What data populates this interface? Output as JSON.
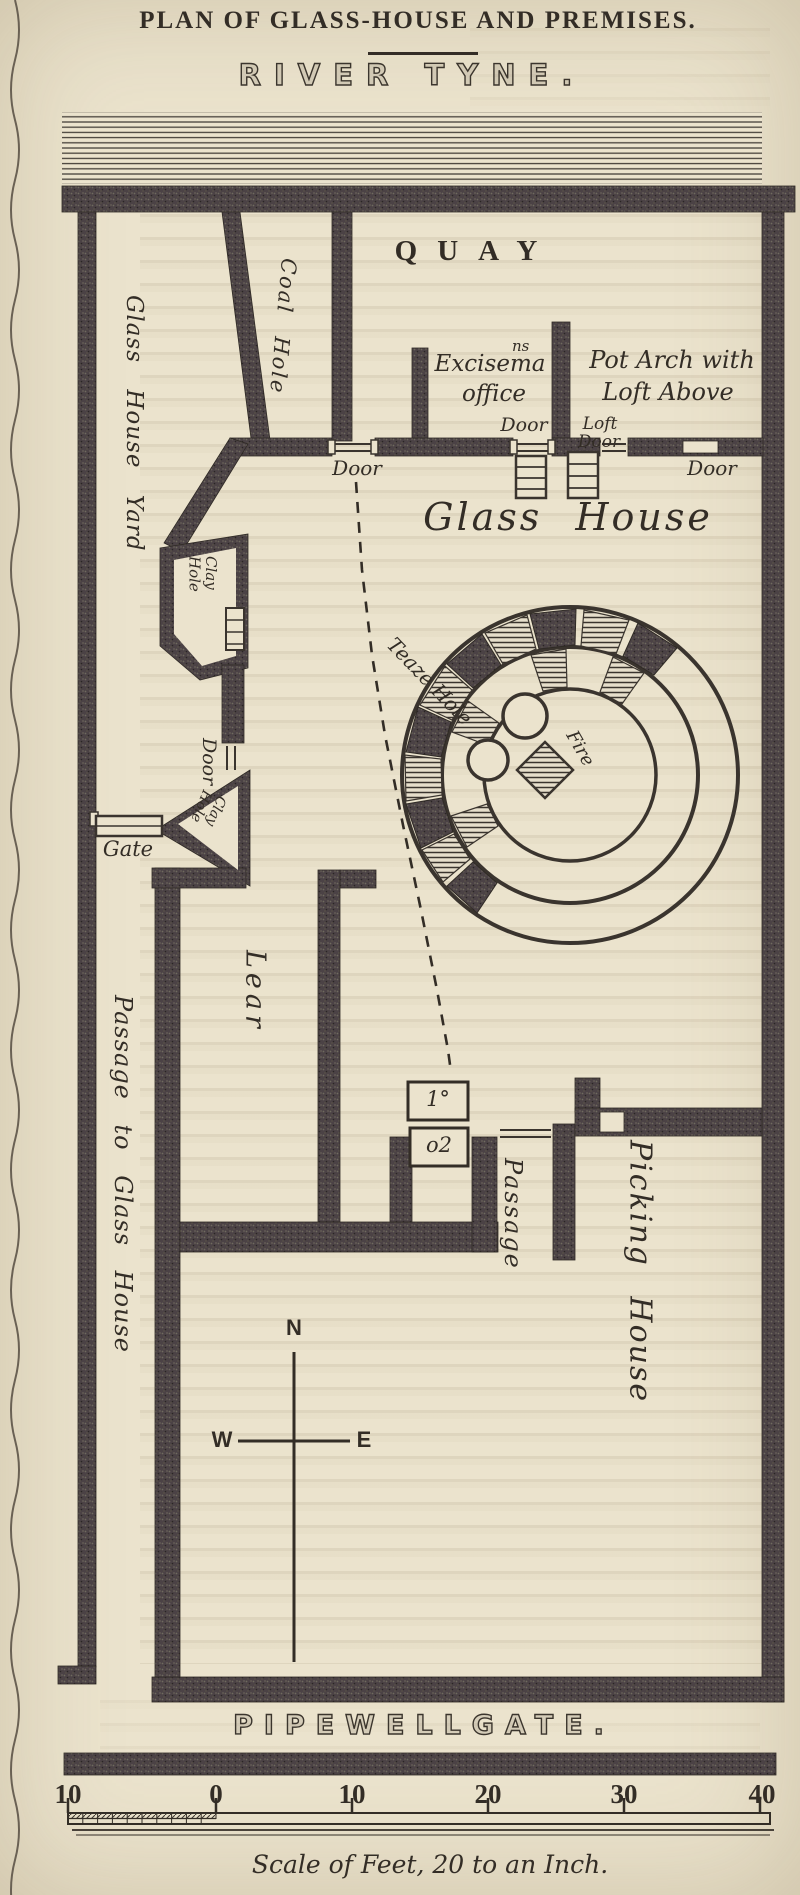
{
  "colors": {
    "paper": "#ebe3cd",
    "ink": "#332d26",
    "wall_dark": "#4b4245"
  },
  "header": {
    "title": "PLAN OF GLASS-HOUSE AND PREMISES.",
    "river": "RIVER TYNE.",
    "quay": "QUAY"
  },
  "plan": {
    "labels": {
      "coal_hole": "Coal Hole",
      "glass_house_yard": "Glass House Yard",
      "exciseman_line1": "Excisema",
      "exciseman_sup": "ns",
      "exciseman_line2": "office",
      "pot_arch_line1": "Pot Arch with",
      "pot_arch_line2": "Loft Above",
      "loft": "Loft",
      "door": "Door",
      "glass_house": "Glass House",
      "teaze_hole": "Teaze Hole",
      "fire": "Fire",
      "clay": "Clay",
      "hole": "Hole",
      "gate": "Gate",
      "lear": "Lear",
      "passage_to_glass_house": "Passage to Glass House",
      "passage": "Passage",
      "picking_house": "Picking House",
      "marker_1": "1°",
      "marker_2": "o2"
    },
    "compass": {
      "north": "N",
      "west": "W",
      "east": "E"
    }
  },
  "footer": {
    "street": "PIPEWELLGATE.",
    "scale_ticks": [
      "10",
      "0",
      "10",
      "20",
      "30",
      "40"
    ],
    "scale_caption": "Scale of Feet, 20 to an Inch."
  }
}
